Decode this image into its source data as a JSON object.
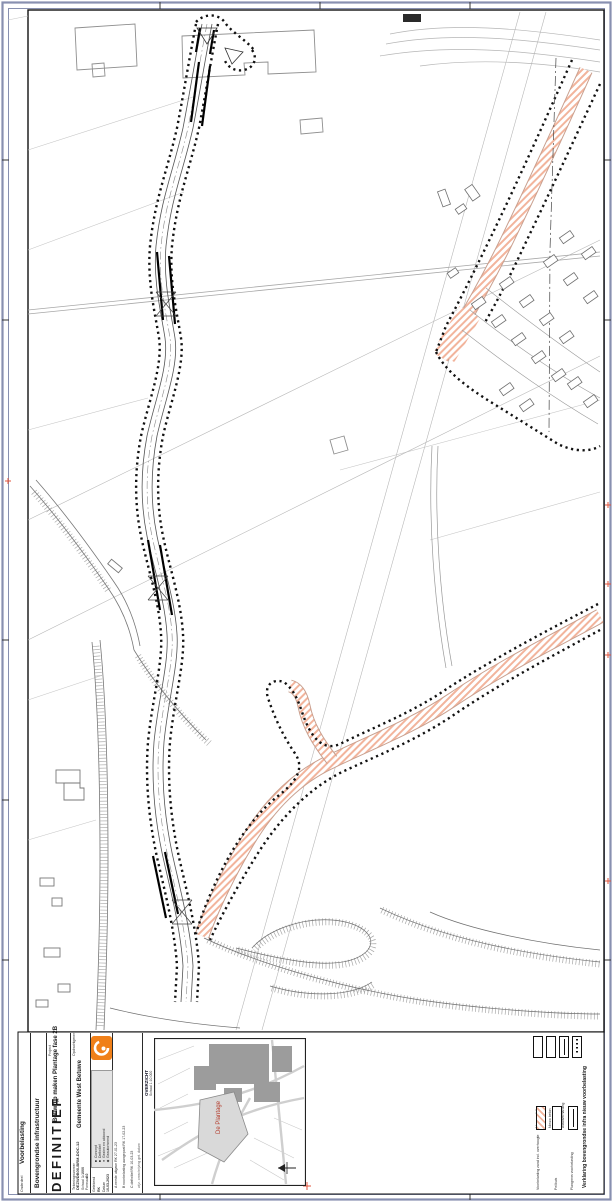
{
  "titleblock": {
    "status": "DEFINITIEF",
    "opdrachtgever_label": "Opdrachtgever",
    "opdrachtgever": "Gemeente West Betuwe",
    "project_label": "Project",
    "project": "Bouwrijp maken Plantage fase 2B",
    "onderdeel_label": "Onderdeel",
    "onderdeel_line1": "Bovengrondse infrastructuur",
    "onderdeel_line2": "Voorbelasting",
    "tekeningnummer_label": "Tekeningnummer",
    "tekeningnummer": "DEZWDB00-BRM-DOC-12",
    "schaal_label": "Schaal",
    "schaal": "1:1000",
    "formaat_label": "Formaat",
    "formaat": "A0",
    "getekend_label": "Getekend",
    "getekend": "RK",
    "datum_label": "Datum",
    "datum": "10-03-2023",
    "autorisatie_rows": [
      "■ Concept",
      "■ Definitief",
      "● Gezien en akkoord",
      "◆ Geautoriseerd"
    ],
    "revision_header": "wijz.  omschrijving  get.  datum",
    "revisions": [
      "C  definitief  RK  10-03-23",
      "B  voorbelasting aangepast  RK  17-02-23",
      "A  eerste uitgave  RK  27-01-23"
    ]
  },
  "inset": {
    "label": "OVERZICHT",
    "schaal": "Schaal 1:10.000",
    "area_label": "De Plantage"
  },
  "legend": {
    "title": "Verklaring bovengrondse infra nieuw voorbelasting",
    "group1": [
      {
        "label": "Nieuw asfalt"
      },
      {
        "label": "Nieuw beton"
      },
      {
        "label": "Asfaltverharding"
      },
      {
        "label": "Zakbaken"
      }
    ],
    "group2": [
      {
        "label": "Voorbelasting zand incl. overhoogte"
      },
      {
        "label": "Peilbuis"
      },
      {
        "label": "Plangrens voorbelasting"
      }
    ]
  },
  "colors": {
    "accent_orange": "#f08019",
    "hatch_salmon": "#f2b49c",
    "tick_red": "#e0543c",
    "border_blue": "#8890b0"
  }
}
